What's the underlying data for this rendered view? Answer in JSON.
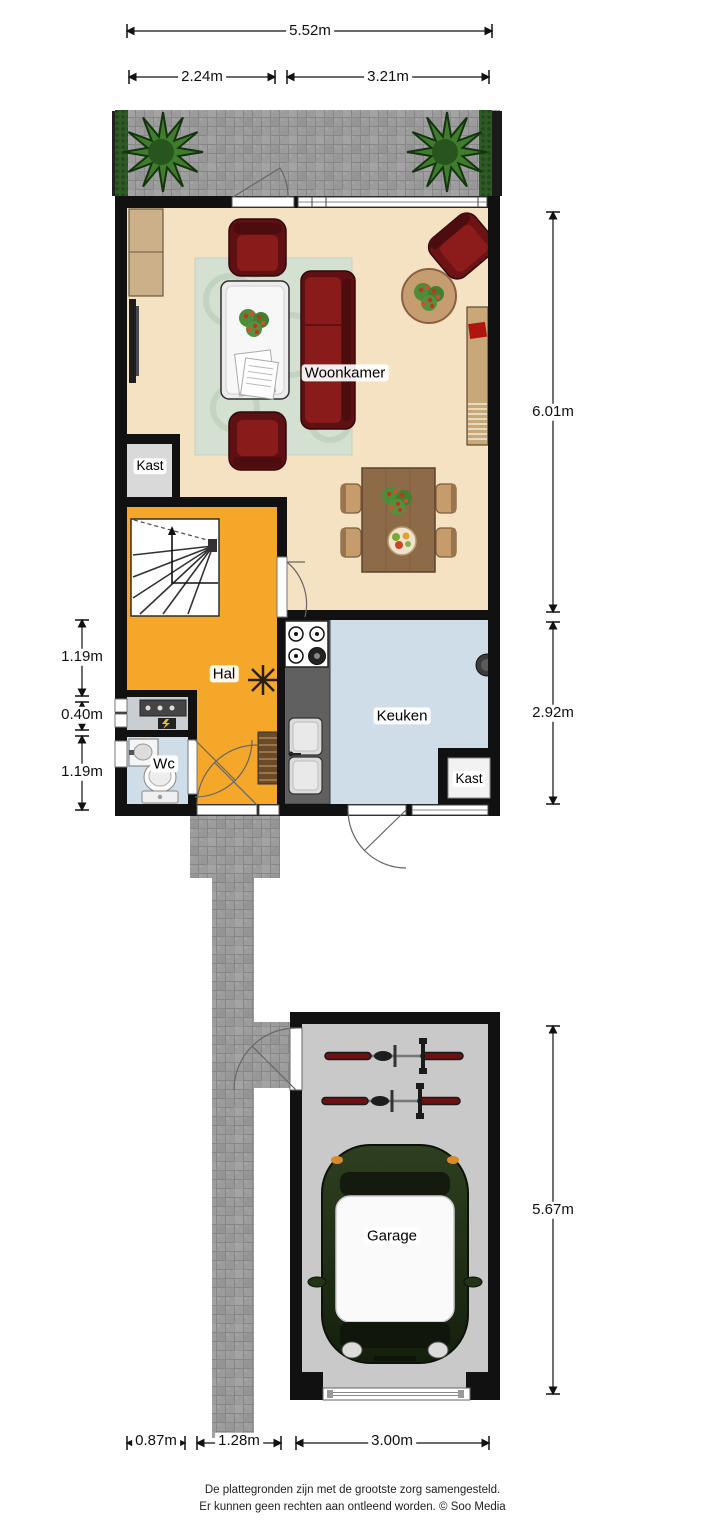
{
  "labels": {
    "woonkamer": "Woonkamer",
    "kast_upper": "Kast",
    "hal": "Hal",
    "wc": "Wc",
    "keuken": "Keuken",
    "kast_keuken": "Kast",
    "garage": "Garage"
  },
  "dims": {
    "top_total": "5.52m",
    "top_left": "2.24m",
    "top_right": "3.21m",
    "side_upper": "6.01m",
    "side_mid": "2.92m",
    "side_garage": "5.67m",
    "left_top": "1.19m",
    "left_mid": "0.40m",
    "left_bottom": "1.19m",
    "bottom_left": "0.87m",
    "bottom_mid": "1.28m",
    "bottom_right": "3.00m"
  },
  "footer": {
    "line1": "De plattegronden zijn met de grootste zorg samengesteld.",
    "line2": "Er kunnen geen rechten aan ontleend worden. © Soo Media"
  },
  "colors": {
    "wall": "#111111",
    "living_floor": "#f4e2c2",
    "hall_floor": "#f5a72a",
    "kitchen_floor": "#cfdde9",
    "closet_floor": "#d9d9d9",
    "garage_floor": "#c9c9c9",
    "tile": "#9c9c9c",
    "hedge": "#2f5c26",
    "shrub": "#3f7d2c",
    "sofa": "#6e1315",
    "rug": "#d3e0d2",
    "dining_table": "#8d6b49",
    "counter": "#606060",
    "car": "#22301a",
    "bike": "#6d1012"
  }
}
